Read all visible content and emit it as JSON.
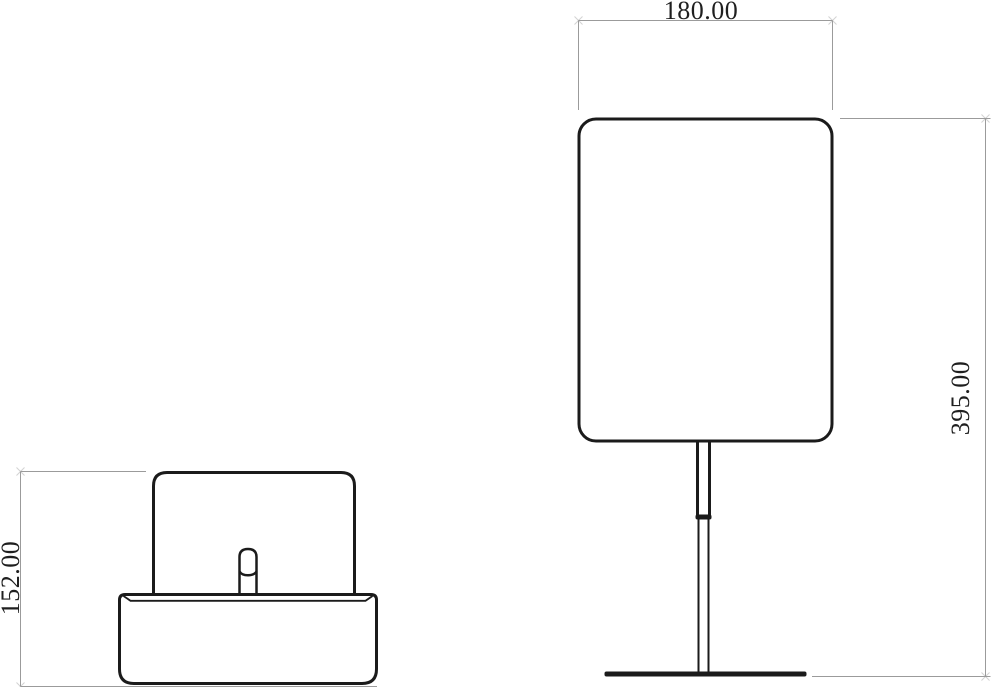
{
  "colors": {
    "background": "#ffffff",
    "outline": "#1b1b1b",
    "dimension_line": "#9b9b9b",
    "dimension_text": "#1f1f1f"
  },
  "dimensions": {
    "front_width": {
      "label": "180.00"
    },
    "front_height": {
      "label": "395.00"
    },
    "side_height": {
      "label": "152.00"
    }
  }
}
